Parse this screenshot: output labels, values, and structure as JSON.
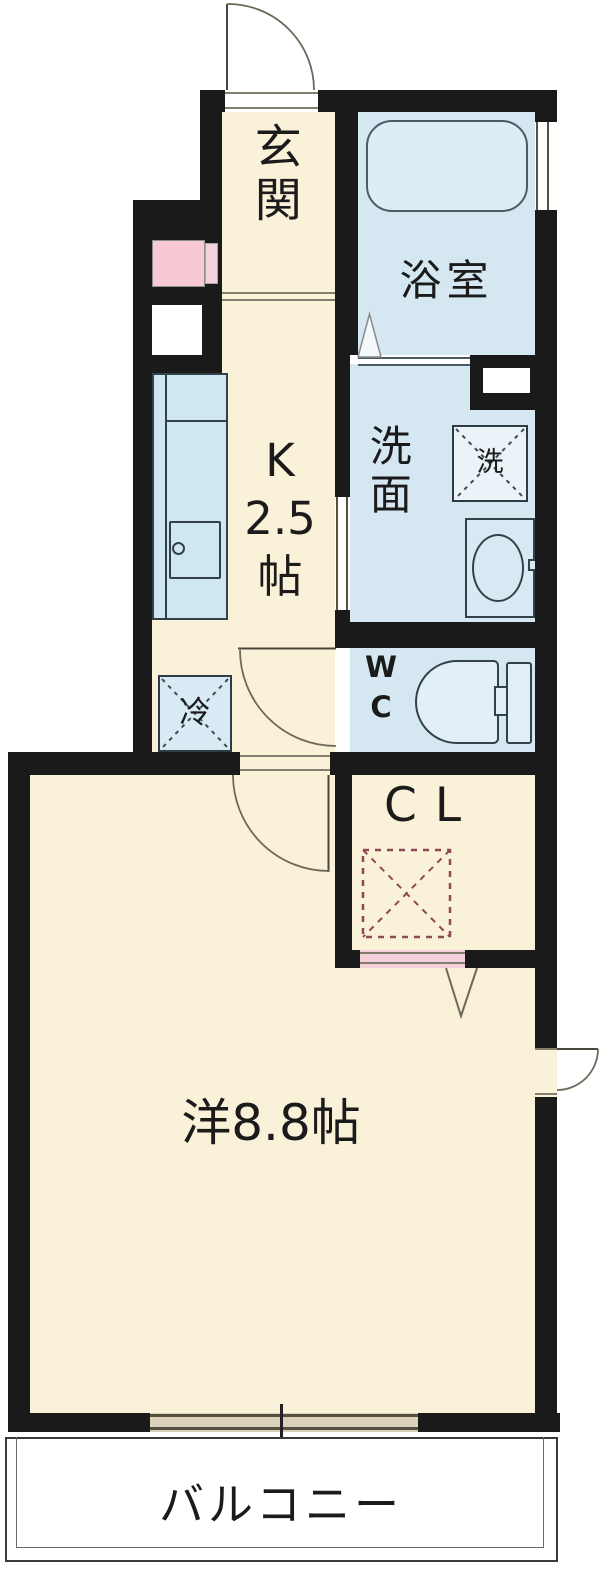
{
  "rooms": {
    "genkan": {
      "label": "玄関"
    },
    "bathroom": {
      "label": "浴室"
    },
    "kitchen": {
      "label_line1": "K",
      "label_line2": "2.5",
      "label_line3": "帖"
    },
    "washroom": {
      "label": "洗面"
    },
    "wc": {
      "label_line1": "W",
      "label_line2": "C"
    },
    "closet": {
      "label": "CL"
    },
    "western_room": {
      "label": "洋8.8帖"
    },
    "balcony": {
      "label": "バルコニー"
    }
  },
  "fixtures": {
    "refrigerator": "冷",
    "washing_machine": "洗"
  },
  "colors": {
    "wall": "#1a1a1a",
    "room_cream": "#faf1d9",
    "wet_area_blue": "#d5e8f2",
    "closet_pink": "#f8d8e1",
    "meter_box_pink": "#f6c9d4",
    "door_swing_line": "#6e685a",
    "window_sill_tan": "#d9d2b8"
  }
}
